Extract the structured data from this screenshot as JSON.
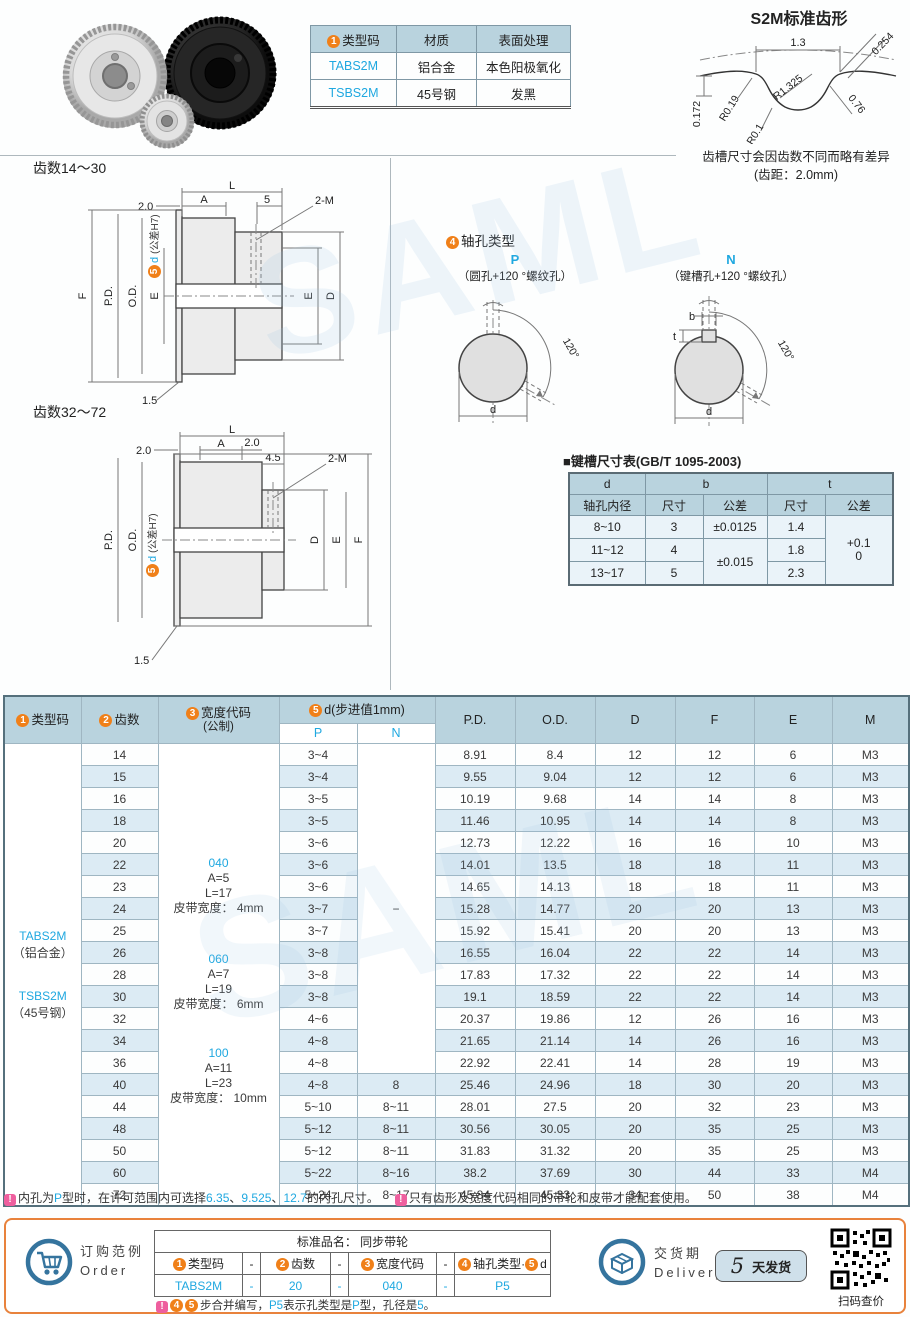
{
  "watermark": "SAML",
  "materials": {
    "h1b": "1",
    "h1": "类型码",
    "h2": "材质",
    "h3": "表面处理",
    "r1c1": "TABS2M",
    "r1c2": "铝合金",
    "r1c3": "本色阳极氧化",
    "r2c1": "TSBS2M",
    "r2c2": "45号钢",
    "r2c3": "发黑"
  },
  "tooth": {
    "title": "S2M标准齿形",
    "w": "1.3",
    "r_tip": "0.254",
    "r1": "R0.19",
    "r2": "R1.325",
    "depth": "0.172",
    "side": "0.76",
    "r3": "R0.1",
    "note1": "齿槽尺寸会因齿数不同而略有差异",
    "note2": "(齿距：2.0mm)"
  },
  "dwg1": {
    "title": "齿数14～30",
    "L": "L",
    "A": "A",
    "off": "2.0",
    "five": "5",
    "screw": "2-M",
    "F": "F",
    "pd": "P.D.",
    "od": "O.D.",
    "e1": "E",
    "e2": "E",
    "d": "D",
    "flange": "1.5",
    "badge": "5",
    "dlab": "d",
    "tol": "(公差H7)"
  },
  "dwg2": {
    "title": "齿数32～72",
    "L": "L",
    "A": "A",
    "off1": "2.0",
    "off2": "2.0",
    "step": "4.5",
    "screw": "2-M",
    "pd": "P.D.",
    "od": "O.D.",
    "d": "D",
    "e": "E",
    "f": "F",
    "flange": "1.5",
    "badge": "5",
    "dlab": "d",
    "tol": "(公差H7)"
  },
  "shaft": {
    "badge": "4",
    "title": "轴孔类型",
    "p": {
      "code": "P",
      "desc": "（圆孔+120 °螺纹孔）",
      "angle": "120°",
      "d": "d"
    },
    "n": {
      "code": "N",
      "desc": "（键槽孔+120 °螺纹孔）",
      "angle": "120°",
      "d": "d",
      "b": "b",
      "t": "t"
    }
  },
  "keyway": {
    "title": "■键槽尺寸表(GB/T 1095-2003)",
    "h_d": "d",
    "h_bore": "轴孔内径",
    "h_b": "b",
    "h_t": "t",
    "h_size": "尺寸",
    "h_tol": "公差",
    "h_size2": "尺寸",
    "h_tol2": "公差",
    "rows": [
      [
        "8~10",
        "3",
        "±0.0125",
        "1.4"
      ],
      [
        "11~12",
        "4",
        "±0.015",
        "1.8"
      ],
      [
        "13~17",
        "5",
        "",
        "2.3"
      ]
    ],
    "t_tol": "+0.1\n0"
  },
  "main_table": {
    "header": {
      "b1": "1",
      "c1": "类型码",
      "b2": "2",
      "c2": "齿数",
      "b3": "3",
      "c3": "宽度代码",
      "c3s": "(公制)",
      "b5": "5",
      "c5": "d(步进值1mm)",
      "p": "P",
      "n": "N",
      "pd": "P.D.",
      "od": "O.D.",
      "d": "D",
      "f": "F",
      "e": "E",
      "m": "M"
    },
    "type_cell": {
      "l1": "TABS2M",
      "l2": "（铝合金）",
      "l3": "TSBS2M",
      "l4": "（45号钢）"
    },
    "width_groups": [
      {
        "code": "040",
        "a": "A=5",
        "l": "L=17",
        "belt": "皮带宽度： 4mm"
      },
      {
        "code": "060",
        "a": "A=7",
        "l": "L=19",
        "belt": "皮带宽度： 6mm"
      },
      {
        "code": "100",
        "a": "A=11",
        "l": "L=23",
        "belt": "皮带宽度： 10mm"
      }
    ],
    "n_dash": "−",
    "rows": [
      [
        "14",
        "3~4",
        null,
        "8.91",
        "8.4",
        "12",
        "12",
        "6",
        "M3"
      ],
      [
        "15",
        "3~4",
        null,
        "9.55",
        "9.04",
        "12",
        "12",
        "6",
        "M3"
      ],
      [
        "16",
        "3~5",
        null,
        "10.19",
        "9.68",
        "14",
        "14",
        "8",
        "M3"
      ],
      [
        "18",
        "3~5",
        null,
        "11.46",
        "10.95",
        "14",
        "14",
        "8",
        "M3"
      ],
      [
        "20",
        "3~6",
        null,
        "12.73",
        "12.22",
        "16",
        "16",
        "10",
        "M3"
      ],
      [
        "22",
        "3~6",
        null,
        "14.01",
        "13.5",
        "18",
        "18",
        "11",
        "M3"
      ],
      [
        "23",
        "3~6",
        null,
        "14.65",
        "14.13",
        "18",
        "18",
        "11",
        "M3"
      ],
      [
        "24",
        "3~7",
        null,
        "15.28",
        "14.77",
        "20",
        "20",
        "13",
        "M3"
      ],
      [
        "25",
        "3~7",
        null,
        "15.92",
        "15.41",
        "20",
        "20",
        "13",
        "M3"
      ],
      [
        "26",
        "3~8",
        null,
        "16.55",
        "16.04",
        "22",
        "22",
        "14",
        "M3"
      ],
      [
        "28",
        "3~8",
        null,
        "17.83",
        "17.32",
        "22",
        "22",
        "14",
        "M3"
      ],
      [
        "30",
        "3~8",
        null,
        "19.1",
        "18.59",
        "22",
        "22",
        "14",
        "M3"
      ],
      [
        "32",
        "4~6",
        null,
        "20.37",
        "19.86",
        "12",
        "26",
        "16",
        "M3"
      ],
      [
        "34",
        "4~8",
        null,
        "21.65",
        "21.14",
        "14",
        "26",
        "16",
        "M3"
      ],
      [
        "36",
        "4~8",
        null,
        "22.92",
        "22.41",
        "14",
        "28",
        "19",
        "M3"
      ],
      [
        "40",
        "4~8",
        "8",
        "25.46",
        "24.96",
        "18",
        "30",
        "20",
        "M3"
      ],
      [
        "44",
        "5~10",
        "8~11",
        "28.01",
        "27.5",
        "20",
        "32",
        "23",
        "M3"
      ],
      [
        "48",
        "5~12",
        "8~11",
        "30.56",
        "30.05",
        "20",
        "35",
        "25",
        "M3"
      ],
      [
        "50",
        "5~12",
        "8~11",
        "31.83",
        "31.32",
        "20",
        "35",
        "25",
        "M3"
      ],
      [
        "60",
        "5~22",
        "8~16",
        "38.2",
        "37.69",
        "30",
        "44",
        "33",
        "M4"
      ],
      [
        "72",
        "5~24",
        "8~17",
        "45.84",
        "45.33",
        "34",
        "50",
        "38",
        "M4"
      ]
    ]
  },
  "notes": {
    "excl": "!",
    "n1": {
      "p1": "内孔为",
      "p2": "P",
      "p3": "型时，在许可范围内可选择",
      "p4": "6.35",
      "p5": "、",
      "p6": "9.525",
      "p7": "、",
      "p8": "12.7",
      "p9": "的内孔尺寸。"
    },
    "n2": {
      "p1": "只有齿形及宽度代码相同的带轮和皮带才能配套使用。"
    }
  },
  "order": {
    "label_cn": "订购范例",
    "label_en": "Order",
    "product_title": "标准品名： 同步带轮",
    "dash": "-",
    "h1b": "1",
    "h1": "类型码",
    "h2b": "2",
    "h2": "齿数",
    "h3b": "3",
    "h3": "宽度代码",
    "h4b": "4",
    "h4a": "轴孔类型·",
    "h4b2": "5",
    "h4c": "d",
    "v1": "TABS2M",
    "v2": "20",
    "v3": "040",
    "v4": "P5",
    "note": {
      "excl": "!",
      "b1": "4",
      "b2": "5",
      "t1": "步合并编写，",
      "t2": "P5",
      "t3": "表示孔类型是",
      "t4": "P",
      "t5": "型，孔径是",
      "t6": "5",
      "t7": "。"
    }
  },
  "delivery": {
    "label_cn": "交货期",
    "label_en": "Delivery",
    "days": "5",
    "unit": "天发货",
    "qr_label": "扫码查价"
  }
}
